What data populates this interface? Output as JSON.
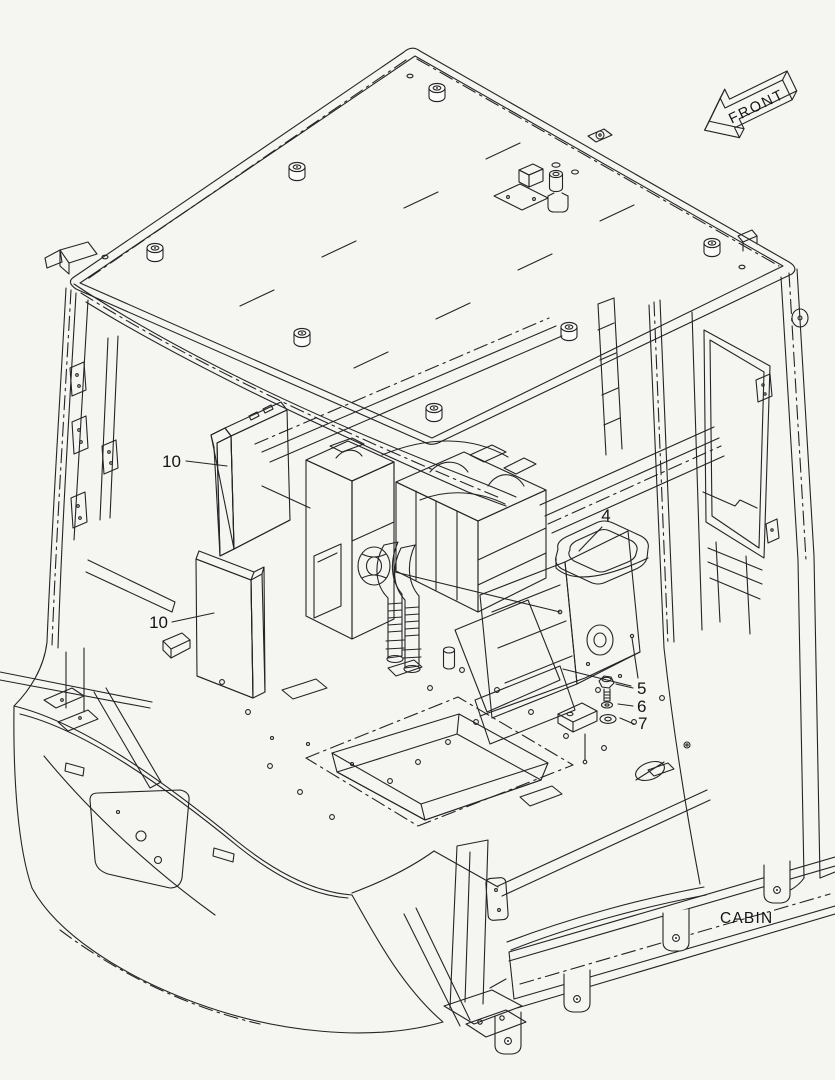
{
  "diagram": {
    "background_color": "#f5f5f2",
    "line_color": "#242424",
    "subject": "cabin-exploded-parts-view"
  },
  "labels": {
    "front": "FRONT",
    "cabin": "CABIN"
  },
  "callouts": {
    "items": [
      {
        "number": "10",
        "target": "air-filter-upper"
      },
      {
        "number": "10",
        "target": "air-filter-lower"
      },
      {
        "number": "4",
        "target": "duct-outlet"
      },
      {
        "number": "5",
        "target": "bolt"
      },
      {
        "number": "6",
        "target": "spring-washer"
      },
      {
        "number": "7",
        "target": "plain-washer"
      }
    ]
  }
}
